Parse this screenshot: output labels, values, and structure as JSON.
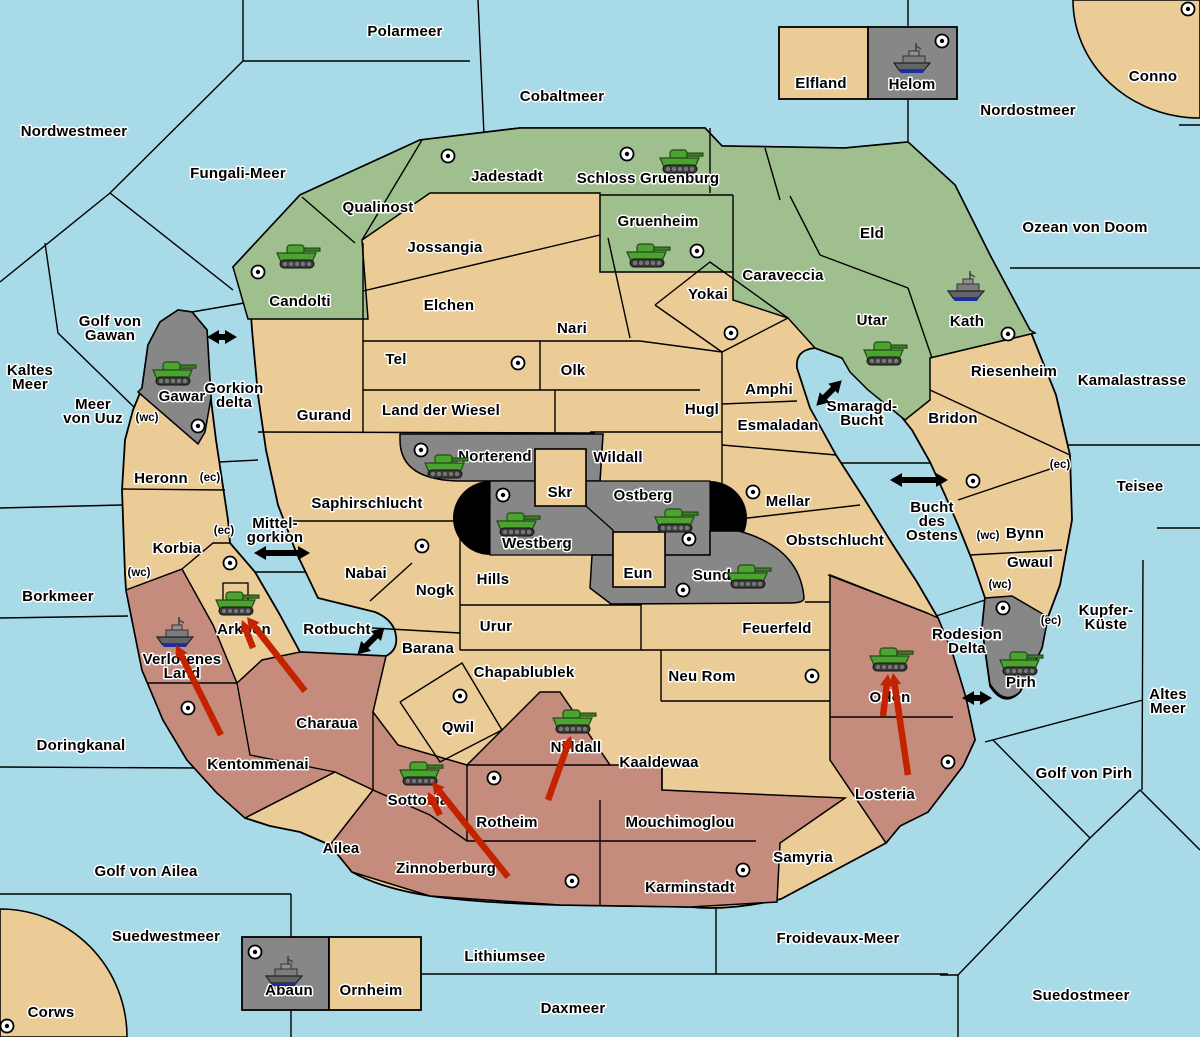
{
  "colors": {
    "sea": "#A9DAE8",
    "land": "#EBCB96",
    "green_zone": "#9FBF8F",
    "red_zone": "#C58C7E",
    "gray_zone": "#878787",
    "fortress_black": "#000000",
    "border": "#000000",
    "label_halo": "#FFFFFF",
    "attack_arrow": "#C42300",
    "link_arrow": "#000000",
    "ship_waterline": "#1C2E9E",
    "tank_green": "#4DA32F"
  },
  "seas": [
    {
      "name": "Polarmeer",
      "lines": [
        "Polarmeer"
      ],
      "x": 405,
      "y": 32
    },
    {
      "name": "Cobaltmeer",
      "lines": [
        "Cobaltmeer"
      ],
      "x": 562,
      "y": 97
    },
    {
      "name": "Nordwestmeer",
      "lines": [
        "Nordwestmeer"
      ],
      "x": 74,
      "y": 132
    },
    {
      "name": "Fungali-Meer",
      "lines": [
        "Fungali-Meer"
      ],
      "x": 238,
      "y": 174
    },
    {
      "name": "Nordostmeer",
      "lines": [
        "Nordostmeer"
      ],
      "x": 1028,
      "y": 111
    },
    {
      "name": "Ozean von Doom",
      "lines": [
        "Ozean von Doom"
      ],
      "x": 1085,
      "y": 228
    },
    {
      "name": "Kamalastrasse",
      "lines": [
        "Kamalastrasse"
      ],
      "x": 1132,
      "y": 381
    },
    {
      "name": "Teisee",
      "lines": [
        "Teisee"
      ],
      "x": 1140,
      "y": 487
    },
    {
      "name": "Kaltes Meer",
      "lines": [
        "Kaltes",
        "Meer"
      ],
      "x": 30,
      "y": 371
    },
    {
      "name": "Meer von Uuz",
      "lines": [
        "Meer",
        "von Uuz"
      ],
      "x": 93,
      "y": 405
    },
    {
      "name": "Golf von Gawan",
      "lines": [
        "Golf von",
        "Gawan"
      ],
      "x": 110,
      "y": 322
    },
    {
      "name": "Gorkion delta",
      "lines": [
        "Gorkion",
        "delta"
      ],
      "x": 234,
      "y": 389
    },
    {
      "name": "Mittel-gorkion",
      "lines": [
        "Mittel-",
        "gorkion"
      ],
      "x": 275,
      "y": 524
    },
    {
      "name": "Smaragd-Bucht",
      "lines": [
        "Smaragd-",
        "Bucht"
      ],
      "x": 862,
      "y": 407
    },
    {
      "name": "Bucht des Ostens",
      "lines": [
        "Bucht",
        "des",
        "Ostens"
      ],
      "x": 932,
      "y": 508
    },
    {
      "name": "Borkmeer",
      "lines": [
        "Borkmeer"
      ],
      "x": 58,
      "y": 597
    },
    {
      "name": "Rotbucht",
      "lines": [
        "Rotbucht"
      ],
      "x": 337,
      "y": 630
    },
    {
      "name": "Doringkanal",
      "lines": [
        "Doringkanal"
      ],
      "x": 81,
      "y": 746
    },
    {
      "name": "Golf von Ailea",
      "lines": [
        "Golf von Ailea"
      ],
      "x": 146,
      "y": 872
    },
    {
      "name": "Suedwestmeer",
      "lines": [
        "Suedwestmeer"
      ],
      "x": 166,
      "y": 937
    },
    {
      "name": "Lithiumsee",
      "lines": [
        "Lithiumsee"
      ],
      "x": 505,
      "y": 957
    },
    {
      "name": "Daxmeer",
      "lines": [
        "Daxmeer"
      ],
      "x": 573,
      "y": 1009
    },
    {
      "name": "Froidevaux-Meer",
      "lines": [
        "Froidevaux-Meer"
      ],
      "x": 838,
      "y": 939
    },
    {
      "name": "Suedostmeer",
      "lines": [
        "Suedostmeer"
      ],
      "x": 1081,
      "y": 996
    },
    {
      "name": "Golf von Pirh",
      "lines": [
        "Golf von Pirh"
      ],
      "x": 1084,
      "y": 774
    },
    {
      "name": "Altes Meer",
      "lines": [
        "Altes",
        "Meer"
      ],
      "x": 1168,
      "y": 695
    },
    {
      "name": "Kupfer-Küste",
      "lines": [
        "Kupfer-",
        "Küste"
      ],
      "x": 1106,
      "y": 611
    },
    {
      "name": "Rodesion Delta",
      "lines": [
        "Rodesion",
        "Delta"
      ],
      "x": 967,
      "y": 635
    }
  ],
  "territories": [
    {
      "name": "Candolti",
      "lines": [
        "Candolti"
      ],
      "x": 300,
      "y": 302,
      "zone": "green"
    },
    {
      "name": "Qualinost",
      "lines": [
        "Qualinost"
      ],
      "x": 378,
      "y": 208,
      "zone": "green"
    },
    {
      "name": "Jadestadt",
      "lines": [
        "Jadestadt"
      ],
      "x": 507,
      "y": 177,
      "zone": "green"
    },
    {
      "name": "Schloss Gruenburg",
      "lines": [
        "Schloss Gruenburg"
      ],
      "x": 648,
      "y": 179,
      "zone": "green"
    },
    {
      "name": "Gruenheim",
      "lines": [
        "Gruenheim"
      ],
      "x": 658,
      "y": 222,
      "zone": "green"
    },
    {
      "name": "Caraveccia",
      "lines": [
        "Caraveccia"
      ],
      "x": 783,
      "y": 276,
      "zone": "green"
    },
    {
      "name": "Eld",
      "lines": [
        "Eld"
      ],
      "x": 872,
      "y": 234,
      "zone": "green"
    },
    {
      "name": "Utar",
      "lines": [
        "Utar"
      ],
      "x": 872,
      "y": 321,
      "zone": "green"
    },
    {
      "name": "Kath",
      "lines": [
        "Kath"
      ],
      "x": 967,
      "y": 322,
      "zone": "green"
    },
    {
      "name": "Gawar",
      "lines": [
        "Gawar"
      ],
      "x": 182,
      "y": 397,
      "zone": "gray"
    },
    {
      "name": "Norterend",
      "lines": [
        "Norterend"
      ],
      "x": 495,
      "y": 457,
      "zone": "gray"
    },
    {
      "name": "Westberg",
      "lines": [
        "Westberg"
      ],
      "x": 537,
      "y": 544,
      "zone": "gray"
    },
    {
      "name": "Ostberg",
      "lines": [
        "Ostberg"
      ],
      "x": 643,
      "y": 496,
      "zone": "gray"
    },
    {
      "name": "Sund",
      "lines": [
        "Sund"
      ],
      "x": 712,
      "y": 576,
      "zone": "gray"
    },
    {
      "name": "Pirh",
      "lines": [
        "Pirh"
      ],
      "x": 1021,
      "y": 683,
      "zone": "gray"
    },
    {
      "name": "Helom",
      "lines": [
        "Helom"
      ],
      "x": 912,
      "y": 85,
      "zone": "gray"
    },
    {
      "name": "Abaun",
      "lines": [
        "Abaun"
      ],
      "x": 289,
      "y": 991,
      "zone": "gray"
    },
    {
      "name": "Elfland",
      "lines": [
        "Elfland"
      ],
      "x": 821,
      "y": 84,
      "zone": "land"
    },
    {
      "name": "Ornheim",
      "lines": [
        "Ornheim"
      ],
      "x": 371,
      "y": 991,
      "zone": "land"
    },
    {
      "name": "Conno",
      "lines": [
        "Conno"
      ],
      "x": 1153,
      "y": 77,
      "zone": "land"
    },
    {
      "name": "Corws",
      "lines": [
        "Corws"
      ],
      "x": 51,
      "y": 1013,
      "zone": "land"
    },
    {
      "name": "Jossangia",
      "lines": [
        "Jossangia"
      ],
      "x": 445,
      "y": 248,
      "zone": "land"
    },
    {
      "name": "Elchen",
      "lines": [
        "Elchen"
      ],
      "x": 449,
      "y": 306,
      "zone": "land"
    },
    {
      "name": "Nari",
      "lines": [
        "Nari"
      ],
      "x": 572,
      "y": 329,
      "zone": "land"
    },
    {
      "name": "Tel",
      "lines": [
        "Tel"
      ],
      "x": 396,
      "y": 360,
      "zone": "land"
    },
    {
      "name": "Olk",
      "lines": [
        "Olk"
      ],
      "x": 573,
      "y": 371,
      "zone": "land"
    },
    {
      "name": "Yokai",
      "lines": [
        "Yokai"
      ],
      "x": 708,
      "y": 295,
      "zone": "land"
    },
    {
      "name": "Gurand",
      "lines": [
        "Gurand"
      ],
      "x": 324,
      "y": 416,
      "zone": "land"
    },
    {
      "name": "Land der Wiesel",
      "lines": [
        "Land der Wiesel"
      ],
      "x": 441,
      "y": 411,
      "zone": "land"
    },
    {
      "name": "Hugl",
      "lines": [
        "Hugl"
      ],
      "x": 702,
      "y": 410,
      "zone": "land"
    },
    {
      "name": "Amphi",
      "lines": [
        "Amphi"
      ],
      "x": 769,
      "y": 390,
      "zone": "land"
    },
    {
      "name": "Esmaladan",
      "lines": [
        "Esmaladan"
      ],
      "x": 778,
      "y": 426,
      "zone": "land"
    },
    {
      "name": "Wildall",
      "lines": [
        "Wildall"
      ],
      "x": 618,
      "y": 458,
      "zone": "land"
    },
    {
      "name": "Mellar",
      "lines": [
        "Mellar"
      ],
      "x": 788,
      "y": 502,
      "zone": "land"
    },
    {
      "name": "Obstschlucht",
      "lines": [
        "Obstschlucht"
      ],
      "x": 835,
      "y": 541,
      "zone": "land"
    },
    {
      "name": "Saphirschlucht",
      "lines": [
        "Saphirschlucht"
      ],
      "x": 367,
      "y": 504,
      "zone": "land"
    },
    {
      "name": "Nabai",
      "lines": [
        "Nabai"
      ],
      "x": 366,
      "y": 574,
      "zone": "land"
    },
    {
      "name": "Nogk",
      "lines": [
        "Nogk"
      ],
      "x": 435,
      "y": 591,
      "zone": "land"
    },
    {
      "name": "Hills",
      "lines": [
        "Hills"
      ],
      "x": 493,
      "y": 580,
      "zone": "land"
    },
    {
      "name": "Urur",
      "lines": [
        "Urur"
      ],
      "x": 496,
      "y": 627,
      "zone": "land"
    },
    {
      "name": "Barana",
      "lines": [
        "Barana"
      ],
      "x": 428,
      "y": 649,
      "zone": "land"
    },
    {
      "name": "Chapablublek",
      "lines": [
        "Chapablublek"
      ],
      "x": 524,
      "y": 673,
      "zone": "land"
    },
    {
      "name": "Qwil",
      "lines": [
        "Qwil"
      ],
      "x": 458,
      "y": 728,
      "zone": "land"
    },
    {
      "name": "Neu Rom",
      "lines": [
        "Neu Rom"
      ],
      "x": 702,
      "y": 677,
      "zone": "land"
    },
    {
      "name": "Feuerfeld",
      "lines": [
        "Feuerfeld"
      ],
      "x": 777,
      "y": 629,
      "zone": "land"
    },
    {
      "name": "Kaaldewaa",
      "lines": [
        "Kaaldewaa"
      ],
      "x": 659,
      "y": 763,
      "zone": "land"
    },
    {
      "name": "Skr",
      "lines": [
        "Skr"
      ],
      "x": 560,
      "y": 493,
      "zone": "land"
    },
    {
      "name": "Eun",
      "lines": [
        "Eun"
      ],
      "x": 638,
      "y": 574,
      "zone": "land"
    },
    {
      "name": "Heronn",
      "lines": [
        "Heronn"
      ],
      "x": 161,
      "y": 479,
      "zone": "land"
    },
    {
      "name": "Korbia",
      "lines": [
        "Korbia"
      ],
      "x": 177,
      "y": 549,
      "zone": "land"
    },
    {
      "name": "Arkoon",
      "lines": [
        "Arkoon"
      ],
      "x": 244,
      "y": 630,
      "zone": "land"
    },
    {
      "name": "Riesenheim",
      "lines": [
        "Riesenheim"
      ],
      "x": 1014,
      "y": 372,
      "zone": "land"
    },
    {
      "name": "Bridon",
      "lines": [
        "Bridon"
      ],
      "x": 953,
      "y": 419,
      "zone": "land"
    },
    {
      "name": "Bynn",
      "lines": [
        "Bynn"
      ],
      "x": 1025,
      "y": 534,
      "zone": "land"
    },
    {
      "name": "Gwaul",
      "lines": [
        "Gwaul"
      ],
      "x": 1030,
      "y": 563,
      "zone": "land"
    },
    {
      "name": "Ailea",
      "lines": [
        "Ailea"
      ],
      "x": 341,
      "y": 849,
      "zone": "land"
    },
    {
      "name": "Samyria",
      "lines": [
        "Samyria"
      ],
      "x": 803,
      "y": 858,
      "zone": "land"
    },
    {
      "name": "Verlorenes Land",
      "lines": [
        "Verlorenes",
        "Land"
      ],
      "x": 182,
      "y": 660,
      "zone": "red"
    },
    {
      "name": "Kentommenai",
      "lines": [
        "Kentommenai"
      ],
      "x": 258,
      "y": 765,
      "zone": "red"
    },
    {
      "name": "Charaua",
      "lines": [
        "Charaua"
      ],
      "x": 327,
      "y": 724,
      "zone": "red"
    },
    {
      "name": "Sottovia",
      "lines": [
        "Sottovia"
      ],
      "x": 418,
      "y": 801,
      "zone": "red"
    },
    {
      "name": "Rotheim",
      "lines": [
        "Rotheim"
      ],
      "x": 507,
      "y": 823,
      "zone": "red"
    },
    {
      "name": "Zinnoberburg",
      "lines": [
        "Zinnoberburg"
      ],
      "x": 446,
      "y": 869,
      "zone": "red"
    },
    {
      "name": "Nilldall",
      "lines": [
        "Nilldall"
      ],
      "x": 576,
      "y": 748,
      "zone": "red"
    },
    {
      "name": "Mouchimoglou",
      "lines": [
        "Mouchimoglou"
      ],
      "x": 680,
      "y": 823,
      "zone": "red"
    },
    {
      "name": "Karminstadt",
      "lines": [
        "Karminstadt"
      ],
      "x": 690,
      "y": 888,
      "zone": "red"
    },
    {
      "name": "Orlon",
      "lines": [
        "Orlon"
      ],
      "x": 890,
      "y": 698,
      "zone": "red"
    },
    {
      "name": "Losteria",
      "lines": [
        "Losteria"
      ],
      "x": 885,
      "y": 795,
      "zone": "red"
    }
  ],
  "coast_tokens": [
    {
      "text": "(wc)",
      "x": 147,
      "y": 418
    },
    {
      "text": "(ec)",
      "x": 210,
      "y": 478
    },
    {
      "text": "(ec)",
      "x": 224,
      "y": 531
    },
    {
      "text": "(wc)",
      "x": 139,
      "y": 573
    },
    {
      "text": "(ec)",
      "x": 1060,
      "y": 465
    },
    {
      "text": "(wc)",
      "x": 988,
      "y": 536
    },
    {
      "text": "(wc)",
      "x": 1000,
      "y": 585
    },
    {
      "text": "(ec)",
      "x": 1051,
      "y": 621
    }
  ],
  "cities": [
    {
      "x": 942,
      "y": 41
    },
    {
      "x": 1188,
      "y": 9
    },
    {
      "x": 448,
      "y": 156
    },
    {
      "x": 627,
      "y": 154
    },
    {
      "x": 258,
      "y": 272
    },
    {
      "x": 697,
      "y": 251
    },
    {
      "x": 518,
      "y": 363
    },
    {
      "x": 731,
      "y": 333
    },
    {
      "x": 1008,
      "y": 334
    },
    {
      "x": 198,
      "y": 426
    },
    {
      "x": 421,
      "y": 450
    },
    {
      "x": 503,
      "y": 495
    },
    {
      "x": 689,
      "y": 539
    },
    {
      "x": 753,
      "y": 492
    },
    {
      "x": 973,
      "y": 481
    },
    {
      "x": 422,
      "y": 546
    },
    {
      "x": 683,
      "y": 590
    },
    {
      "x": 1003,
      "y": 608
    },
    {
      "x": 230,
      "y": 563
    },
    {
      "x": 188,
      "y": 708
    },
    {
      "x": 460,
      "y": 696
    },
    {
      "x": 494,
      "y": 778
    },
    {
      "x": 572,
      "y": 881
    },
    {
      "x": 743,
      "y": 870
    },
    {
      "x": 812,
      "y": 676
    },
    {
      "x": 948,
      "y": 762
    },
    {
      "x": 255,
      "y": 952
    },
    {
      "x": 7,
      "y": 1026
    }
  ],
  "tanks": [
    {
      "territory": "Candolti",
      "x": 297,
      "y": 258
    },
    {
      "territory": "Schloss Gruenburg",
      "x": 680,
      "y": 163
    },
    {
      "territory": "Gruenheim",
      "x": 647,
      "y": 257
    },
    {
      "territory": "Utar",
      "x": 884,
      "y": 355
    },
    {
      "territory": "Gawar",
      "x": 173,
      "y": 375
    },
    {
      "territory": "Norterend",
      "x": 445,
      "y": 468
    },
    {
      "territory": "Westberg",
      "x": 517,
      "y": 526
    },
    {
      "territory": "Ostberg",
      "x": 675,
      "y": 522
    },
    {
      "territory": "Sund",
      "x": 748,
      "y": 578
    },
    {
      "territory": "Arkoon",
      "x": 236,
      "y": 605
    },
    {
      "territory": "Nilldall",
      "x": 573,
      "y": 723
    },
    {
      "territory": "Sottovia",
      "x": 420,
      "y": 775
    },
    {
      "territory": "Orlon",
      "x": 890,
      "y": 661
    },
    {
      "territory": "Pirh",
      "x": 1020,
      "y": 665
    }
  ],
  "ships": [
    {
      "territory": "Helom",
      "x": 913,
      "y": 60
    },
    {
      "territory": "Kath",
      "x": 967,
      "y": 288
    },
    {
      "territory": "Verlorenes Land",
      "x": 176,
      "y": 634
    },
    {
      "territory": "Abaun",
      "x": 285,
      "y": 973
    }
  ],
  "attack_arrows": [
    {
      "x1": 221,
      "y1": 735,
      "x2": 176,
      "y2": 645
    },
    {
      "x1": 305,
      "y1": 691,
      "x2": 247,
      "y2": 617
    },
    {
      "x1": 253,
      "y1": 648,
      "x2": 242,
      "y2": 620
    },
    {
      "x1": 548,
      "y1": 800,
      "x2": 571,
      "y2": 736
    },
    {
      "x1": 508,
      "y1": 877,
      "x2": 432,
      "y2": 782
    },
    {
      "x1": 440,
      "y1": 815,
      "x2": 428,
      "y2": 792
    },
    {
      "x1": 908,
      "y1": 775,
      "x2": 893,
      "y2": 673
    },
    {
      "x1": 883,
      "y1": 716,
      "x2": 888,
      "y2": 674
    }
  ],
  "link_arrows": [
    {
      "x": 222,
      "y": 337,
      "len": 30,
      "angle": 0
    },
    {
      "x": 282,
      "y": 553,
      "len": 56,
      "angle": 0
    },
    {
      "x": 371,
      "y": 641,
      "len": 38,
      "angle": -45
    },
    {
      "x": 829,
      "y": 393,
      "len": 36,
      "angle": -45
    },
    {
      "x": 919,
      "y": 480,
      "len": 58,
      "angle": 0
    },
    {
      "x": 977,
      "y": 698,
      "len": 30,
      "angle": 0
    }
  ]
}
